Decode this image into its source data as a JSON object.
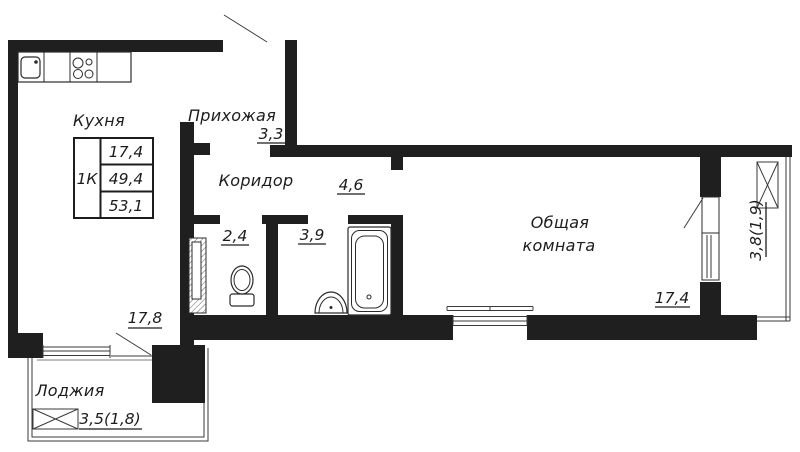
{
  "legend": {
    "type": "1К",
    "rows": [
      "17,4",
      "49,4",
      "53,1"
    ]
  },
  "rooms": {
    "kitchen": {
      "label": "Кухня",
      "area": "17,8"
    },
    "hallway": {
      "label": "Прихожая",
      "area": "3,3"
    },
    "corridor": {
      "label": "Коридор",
      "area": "4,6"
    },
    "wc": {
      "area": "2,4"
    },
    "bathroom": {
      "area": "3,9"
    },
    "living_room": {
      "label_line1": "Общая",
      "label_line2": "комната",
      "area": "17,4"
    },
    "loggia": {
      "label": "Лоджия",
      "area": "3,5(1,8)"
    },
    "balcony": {
      "area": "3,8(1,9)"
    }
  },
  "fixtures": [
    "kitchen-sink-icon",
    "stove-icon",
    "toilet-icon",
    "vent-shaft-icon",
    "bathtub-icon",
    "washbasin-icon",
    "window-icon",
    "door-swing-icon",
    "crossed-window-icon"
  ],
  "colors": {
    "wall": "#1f1f1f",
    "line": "#3a3a3a",
    "background": "#ffffff"
  }
}
